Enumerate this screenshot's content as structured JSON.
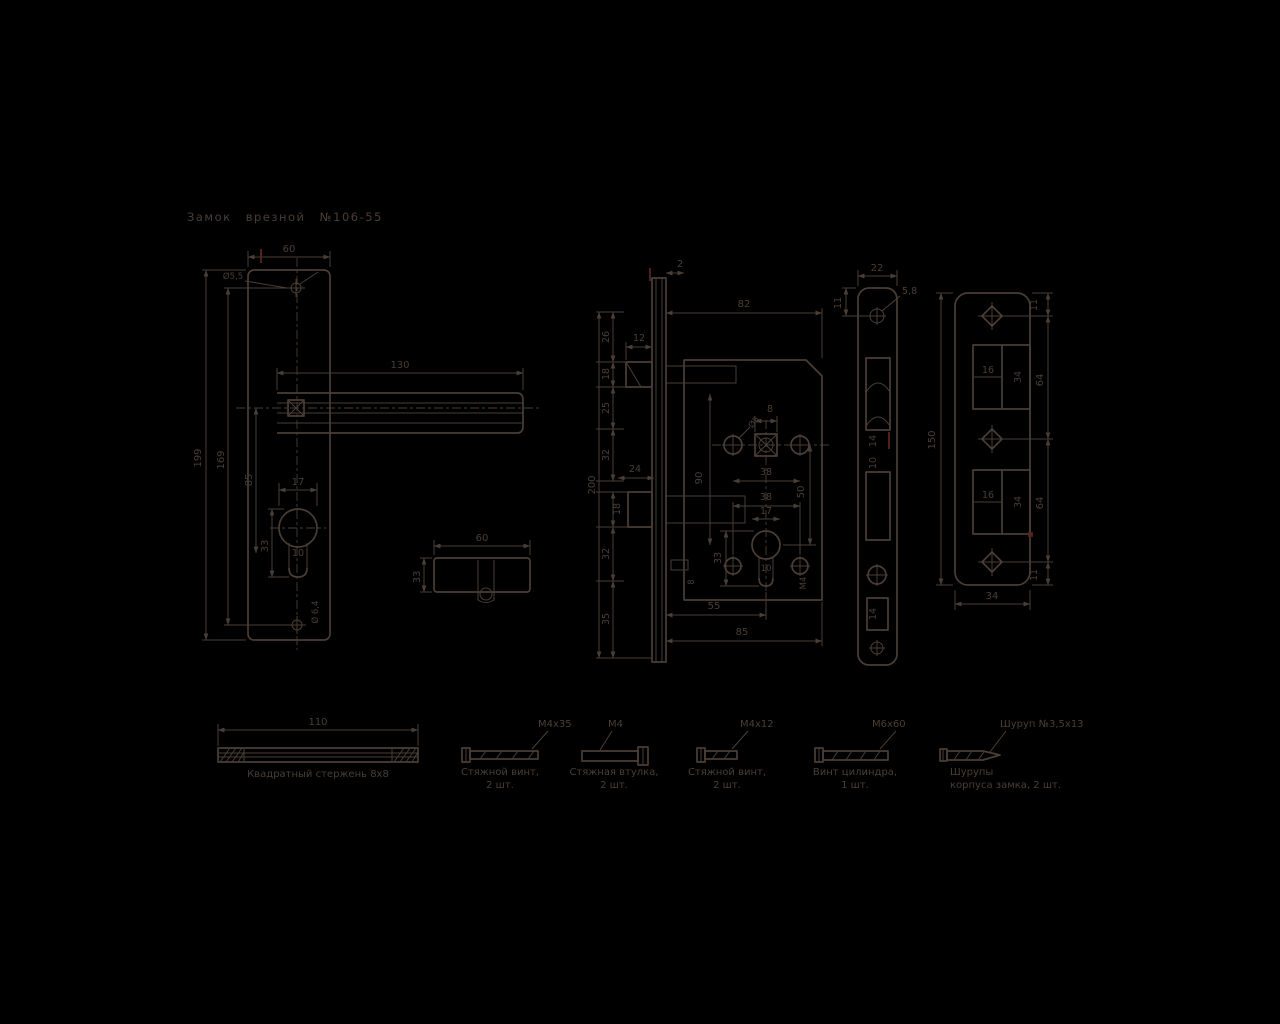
{
  "title": "Замок врезной №106-55",
  "colors": {
    "background": "#000000",
    "ink": "#4a3e36",
    "accent": "#5a241d"
  },
  "handle_plate": {
    "width": "60",
    "height": "199",
    "holes_span": "169",
    "axes_span": "85",
    "handle_length": "130",
    "top_hole_dia": "Ø5,5",
    "cyl_width": "17",
    "cyl_slot_width": "10",
    "cyl_height": "33",
    "bottom_hole_dia": "Ø 6,4"
  },
  "cylinder": {
    "length": "60",
    "height": "33"
  },
  "lock_body": {
    "face_gap": "2",
    "width": "82",
    "seg_26": "26",
    "latch_depth": "12",
    "latch_height": "18",
    "seg_25": "25",
    "seg_32a": "32",
    "bolt_depth": "24",
    "bolt_height": "18",
    "seg_32b": "32",
    "seg_35": "35",
    "total_height": "200",
    "inner_span": "90",
    "hole_callout": "Ø5",
    "spindle_square": "8",
    "top_holes_span": "38",
    "bottom_holes_span": "38",
    "axes_span": "50",
    "cyl_width": "17",
    "cyl_slot_width": "10",
    "cyl_height": "33",
    "slot_label": "8",
    "thread_label": "М4",
    "backset": "55",
    "body_depth": "85"
  },
  "faceplate": {
    "width": "22",
    "screw_hole": "5,8",
    "top_offset": "11",
    "latch_window": "14",
    "window_gap": "10",
    "bottom_window": "14"
  },
  "strike_plate": {
    "height": "150",
    "top_offset": "11",
    "upper_span": "64",
    "lower_span": "64",
    "bottom_offset": "11",
    "cutout_width_1": "16",
    "cutout_height_1": "34",
    "cutout_width_2": "16",
    "cutout_height_2": "34",
    "width": "34"
  },
  "hardware": {
    "rod": {
      "length": "110",
      "label": "Квадратный стержень 8х8"
    },
    "item1": {
      "size": "М4х35",
      "line1": "Стяжной винт,",
      "line2": "2 шт."
    },
    "item2": {
      "size": "М4",
      "line1": "Стяжная втулка,",
      "line2": "2 шт."
    },
    "item3": {
      "size": "М4х12",
      "line1": "Стяжной винт,",
      "line2": "2 шт."
    },
    "item4": {
      "size": "М6х60",
      "line1": "Винт цилиндра,",
      "line2": "1 шт."
    },
    "item5": {
      "size": "Шуруп №3,5х13",
      "line1": "Шурупы",
      "line2": "корпуса замка, 2 шт."
    }
  }
}
